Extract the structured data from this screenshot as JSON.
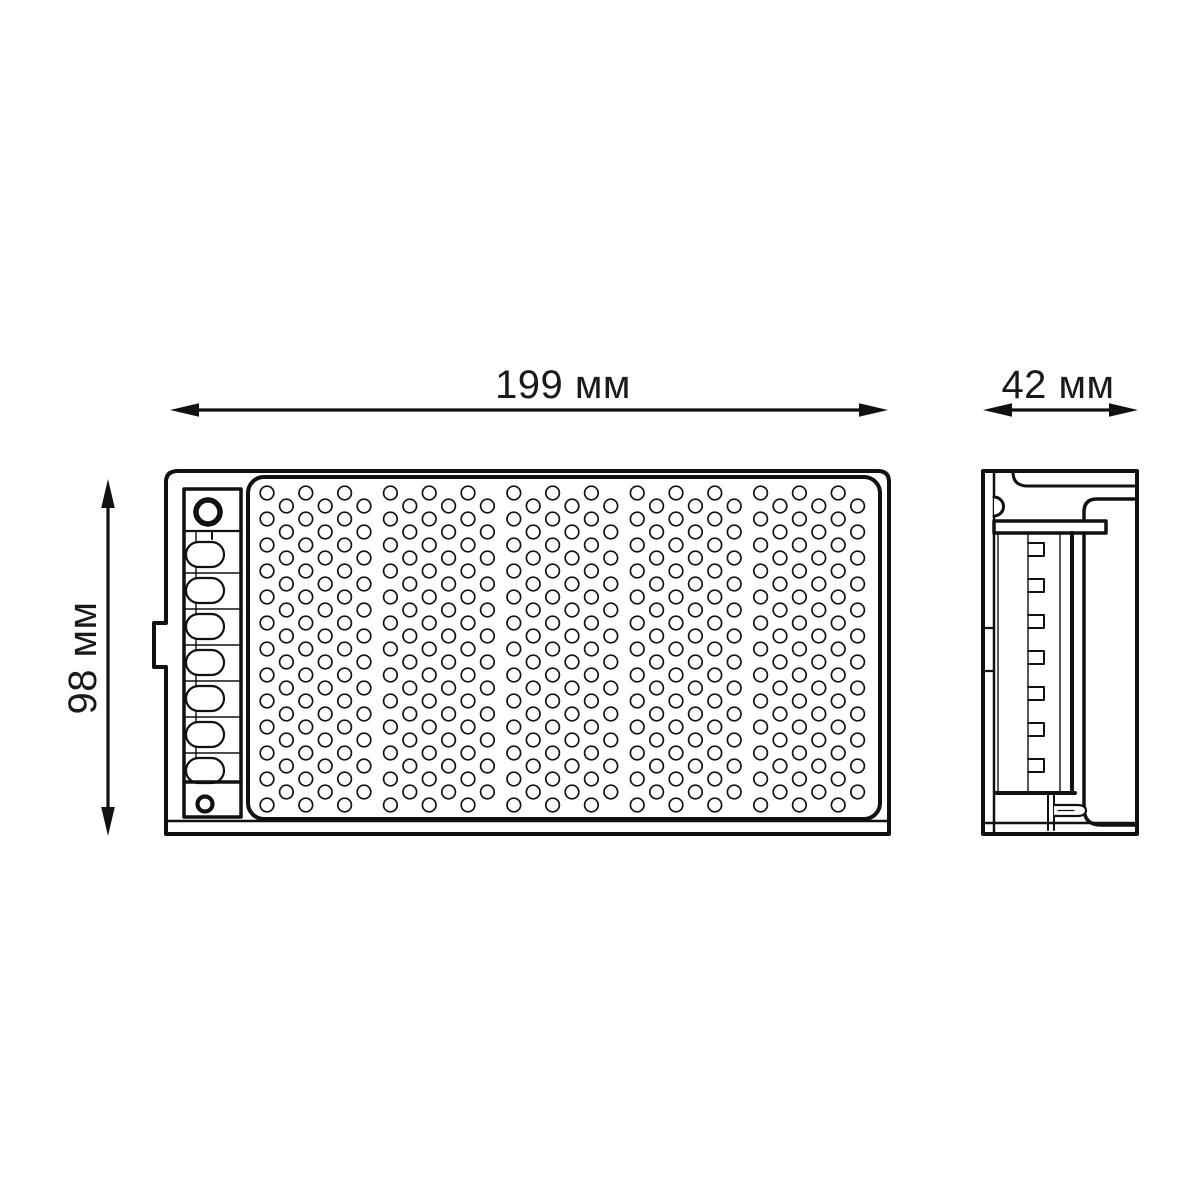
{
  "background": "#ffffff",
  "line_color": "#111111",
  "labels": {
    "width": "199 мм",
    "depth": "42 мм",
    "height": "98 мм"
  },
  "front_view": {
    "grille": {
      "columns": 30,
      "group_size": 6,
      "group_gap": 7,
      "hole_radius": 6.8,
      "x0": 267,
      "dx": 19.4,
      "y0_even": 493,
      "y0_odd": 506,
      "dy": 26,
      "rows_even": 13,
      "rows_odd": 12
    },
    "terminal_slots": {
      "count": 7,
      "x": 186,
      "width": 38,
      "height": 25,
      "y0": 542,
      "pitch": 36,
      "block_left": 184,
      "block_right": 241
    },
    "screw_holes": 2
  },
  "side_view": {
    "teeth": {
      "count": 7,
      "x": 1028,
      "width": 16,
      "height": 13,
      "y0": 543,
      "pitch": 36
    }
  }
}
